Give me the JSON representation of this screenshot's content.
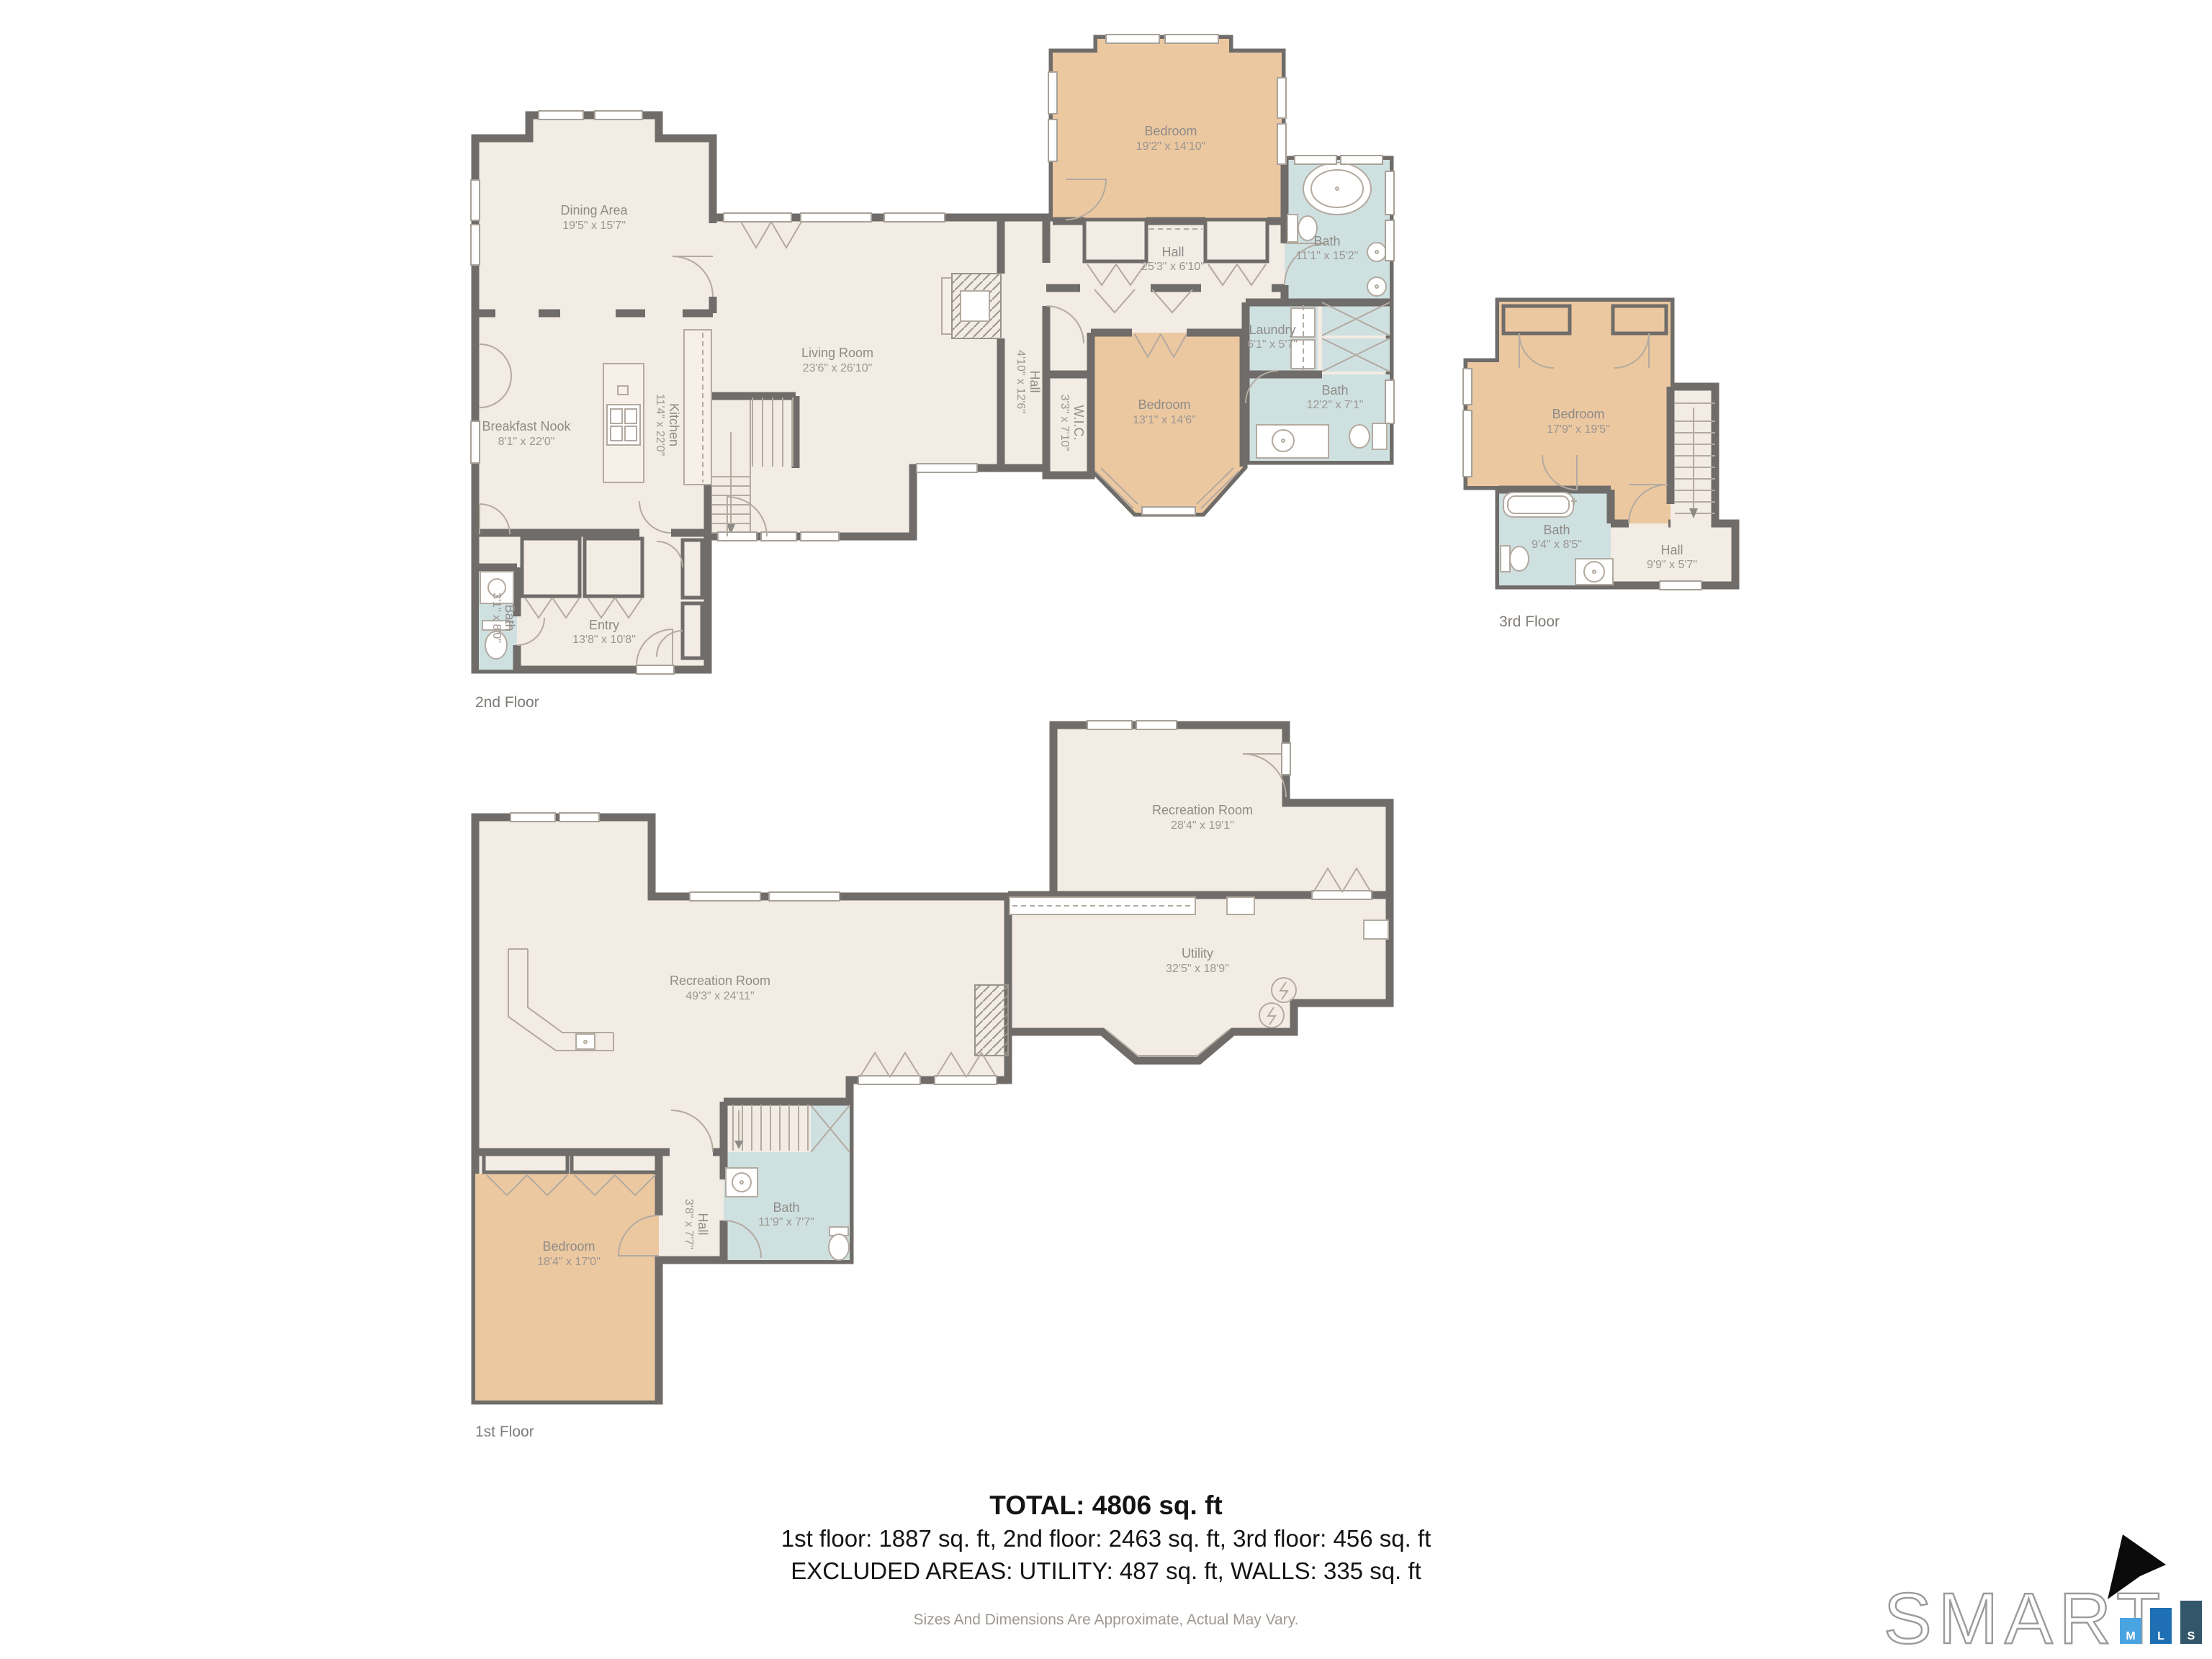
{
  "summary": {
    "total": "TOTAL: 4806 sq. ft",
    "by_floor": "1st floor: 1887 sq. ft, 2nd floor: 2463 sq. ft, 3rd floor: 456 sq. ft",
    "excluded": "EXCLUDED AREAS: UTILITY: 487 sq. ft, WALLS: 335 sq. ft",
    "disclaimer": "Sizes And Dimensions Are Approximate, Actual May Vary."
  },
  "floors": {
    "second": {
      "label": "2nd Floor",
      "rooms": {
        "dining": {
          "name": "Dining Area",
          "dims": "19'5\" x 15'7\""
        },
        "living": {
          "name": "Living Room",
          "dims": "23'6\" x 26'10\""
        },
        "breakfast": {
          "name": "Breakfast Nook",
          "dims": "8'1\" x 22'0\""
        },
        "kitchen": {
          "name": "Kitchen",
          "dims": "11'4\" x 22'0\""
        },
        "bedroom_top": {
          "name": "Bedroom",
          "dims": "19'2\" x 14'10\""
        },
        "bath_top": {
          "name": "Bath",
          "dims": "11'1\" x 15'2\""
        },
        "hall_top": {
          "name": "Hall",
          "dims": "25'3\" x 6'10\""
        },
        "hall_mid": {
          "name": "Hall",
          "dims": "4'10\" x 12'6\""
        },
        "laundry": {
          "name": "Laundry",
          "dims": "6'1\" x 5'7\""
        },
        "bath_mid": {
          "name": "Bath",
          "dims": "12'2\" x 7'1\""
        },
        "bedroom_mid": {
          "name": "Bedroom",
          "dims": "13'1\" x 14'6\""
        },
        "wic": {
          "name": "W.I.C.",
          "dims": "3'3\" x 7'10\""
        },
        "entry": {
          "name": "Entry",
          "dims": "13'8\" x 10'8\""
        },
        "bath_entry": {
          "name": "Bath",
          "dims": "3'1\" x 8'0\""
        }
      }
    },
    "third": {
      "label": "3rd Floor",
      "rooms": {
        "bedroom": {
          "name": "Bedroom",
          "dims": "17'9\" x 19'5\""
        },
        "bath": {
          "name": "Bath",
          "dims": "9'4\" x 8'5\""
        },
        "hall": {
          "name": "Hall",
          "dims": "9'9\" x 5'7\""
        }
      }
    },
    "first": {
      "label": "1st Floor",
      "rooms": {
        "rec_left": {
          "name": "Recreation Room",
          "dims": "49'3\" x 24'11\""
        },
        "rec_right": {
          "name": "Recreation Room",
          "dims": "28'4\" x 19'1\""
        },
        "utility": {
          "name": "Utility",
          "dims": "32'5\" x 18'9\""
        },
        "bedroom": {
          "name": "Bedroom",
          "dims": "18'4\" x 17'0\""
        },
        "bath": {
          "name": "Bath",
          "dims": "11'9\" x 7'7\""
        },
        "hall": {
          "name": "Hall",
          "dims": "3'8\" x 7'7\""
        }
      }
    }
  },
  "logo": {
    "brand": "SMART",
    "bars": [
      "M",
      "L",
      "S"
    ]
  },
  "colors": {
    "floor_beige": "#f3ece4",
    "bedroom_tan": "#ecc8a1",
    "bath_blue": "#cfe0e1",
    "wall_gray": "#6f6c69",
    "bar_m_blue": "#49a4e2",
    "bar_l_blue": "#1e6fb3",
    "bar_s_slate": "#32576b"
  }
}
